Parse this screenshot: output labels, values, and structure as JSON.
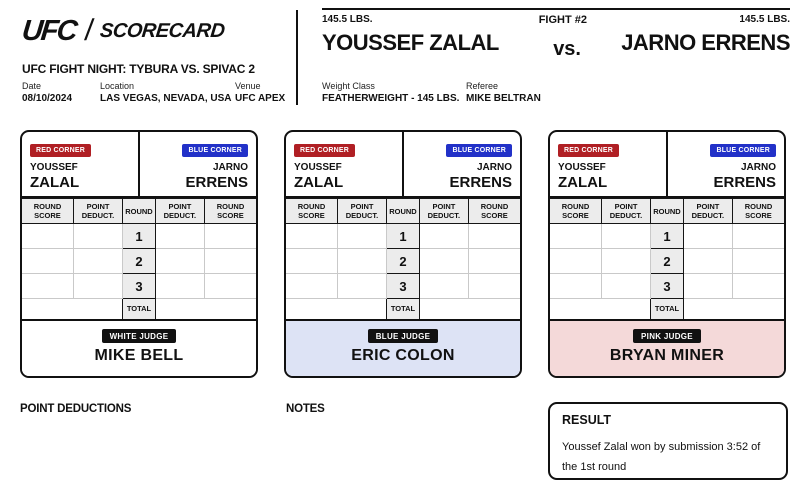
{
  "colors": {
    "red_corner": "#b01f24",
    "blue_corner": "#2231c8",
    "badge_black": "#111111",
    "grid_light": "#c9c9c9"
  },
  "brand": {
    "logo": "UFC",
    "wordmark": "SCORECARD"
  },
  "event": {
    "title": "UFC FIGHT NIGHT: TYBURA VS. SPIVAC 2",
    "date_label": "Date",
    "date": "08/10/2024",
    "location_label": "Location",
    "location": "LAS VEGAS, NEVADA, USA",
    "venue_label": "Venue",
    "venue": "UFC APEX"
  },
  "fight": {
    "number": "FIGHT #2",
    "vs": "vs.",
    "red_weight": "145.5 LBS.",
    "red_name": "YOUSSEF ZALAL",
    "blue_weight": "145.5 LBS.",
    "blue_name": "JARNO ERRENS",
    "weight_class_label": "Weight Class",
    "weight_class": "FEATHERWEIGHT - 145 LBS.",
    "referee_label": "Referee",
    "referee": "MIKE BELTRAN"
  },
  "scorecard": {
    "red_corner_label": "RED CORNER",
    "blue_corner_label": "BLUE CORNER",
    "red_first": "YOUSSEF",
    "red_last": "ZALAL",
    "blue_first": "JARNO",
    "blue_last": "ERRENS",
    "columns": [
      "ROUND SCORE",
      "POINT DEDUCT.",
      "ROUND",
      "POINT DEDUCT.",
      "ROUND SCORE"
    ],
    "rounds": [
      "1",
      "2",
      "3"
    ],
    "total_label": "TOTAL"
  },
  "judges": [
    {
      "role": "WHITE JUDGE",
      "name": "MIKE BELL",
      "footer_bg": "#ffffff"
    },
    {
      "role": "BLUE JUDGE",
      "name": "ERIC COLON",
      "footer_bg": "#dde3f5"
    },
    {
      "role": "PINK JUDGE",
      "name": "BRYAN MINER",
      "footer_bg": "#f4d9d9"
    }
  ],
  "footer": {
    "point_deductions_label": "POINT DEDUCTIONS",
    "notes_label": "NOTES",
    "result_label": "RESULT",
    "result_text": "Youssef Zalal won by submission 3:52 of the 1st round"
  }
}
